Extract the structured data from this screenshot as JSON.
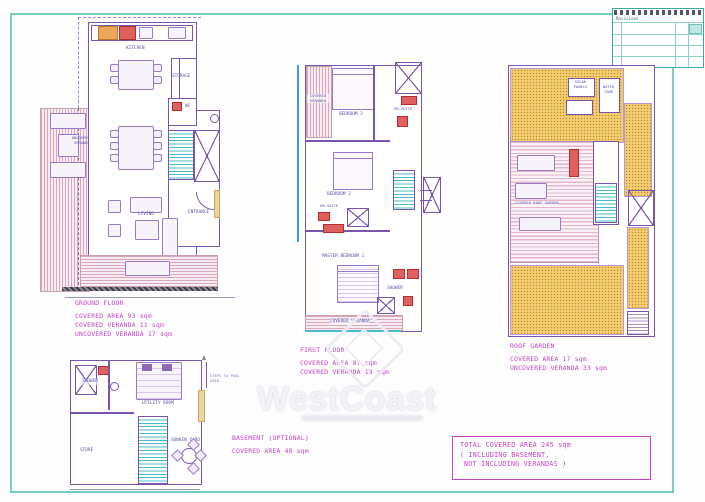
{
  "sheet": {
    "watermark": "WestCoast",
    "title_block_title": "Revisions"
  },
  "plans": {
    "ground": {
      "name": "GROUND FLOOR",
      "stats": [
        "COVERED AREA 93 sqm",
        "COVERED VERANDA 11 sqm",
        "UNCOVERED VERANDA 17 sqm"
      ],
      "labels": {
        "kitchen": "KITCHEN",
        "storage": "STORAGE",
        "wc": "WC",
        "entrance": "ENTRANCE",
        "living": "LIVING",
        "uncovered_veranda": "UNCOVERED VERANDA"
      }
    },
    "first": {
      "name": "FIRST FLOOR",
      "stats": [
        "COVERED AREA 87 sqm",
        "COVERED VERANDA 13 sqm"
      ],
      "labels": {
        "bedroom3": "BEDROOM 3",
        "ensuite3": "EN-SUITE",
        "bedroom2": "BEDROOM 2",
        "ensuite2": "EN-SUITE",
        "master": "MASTER BEDROOM 1",
        "shower": "SHOWER",
        "veranda_side": "COVERED VERANDA",
        "veranda_bottom": "COVERED VERANDA"
      }
    },
    "roof": {
      "name": "ROOF GARDEN",
      "stats": [
        "COVERED AREA 17 sqm",
        "UNCOVERED VERANDA 33 sqm"
      ],
      "labels": {
        "solar": "SOLAR PANELS",
        "tank": "WATER TANK",
        "pergola": "COVERED ROOF GARDEN"
      }
    },
    "basement": {
      "name": "BASEMENT (OPTIONAL)",
      "stats": [
        "COVERED AREA 48 sqm"
      ],
      "labels": {
        "shower": "SHOWER",
        "utility": "UTILITY ROOM",
        "store": "STORE",
        "sunken": "SUNKEN YARD",
        "steps": "STEPS TO POOL AREA"
      }
    }
  },
  "summary": {
    "lines": [
      "TOTAL COVERED AREA 245 sqm",
      "( INCLUDING BASEMENT,",
      "NOT INCLUDING VERANDAS )"
    ]
  },
  "colors": {
    "accent_magenta": "#c544c5",
    "wall_purple": "#7a55ad",
    "stair_cyan": "#49bccb",
    "roof_yellow": "#f2cd72",
    "frame_teal": "#79ccc1"
  }
}
